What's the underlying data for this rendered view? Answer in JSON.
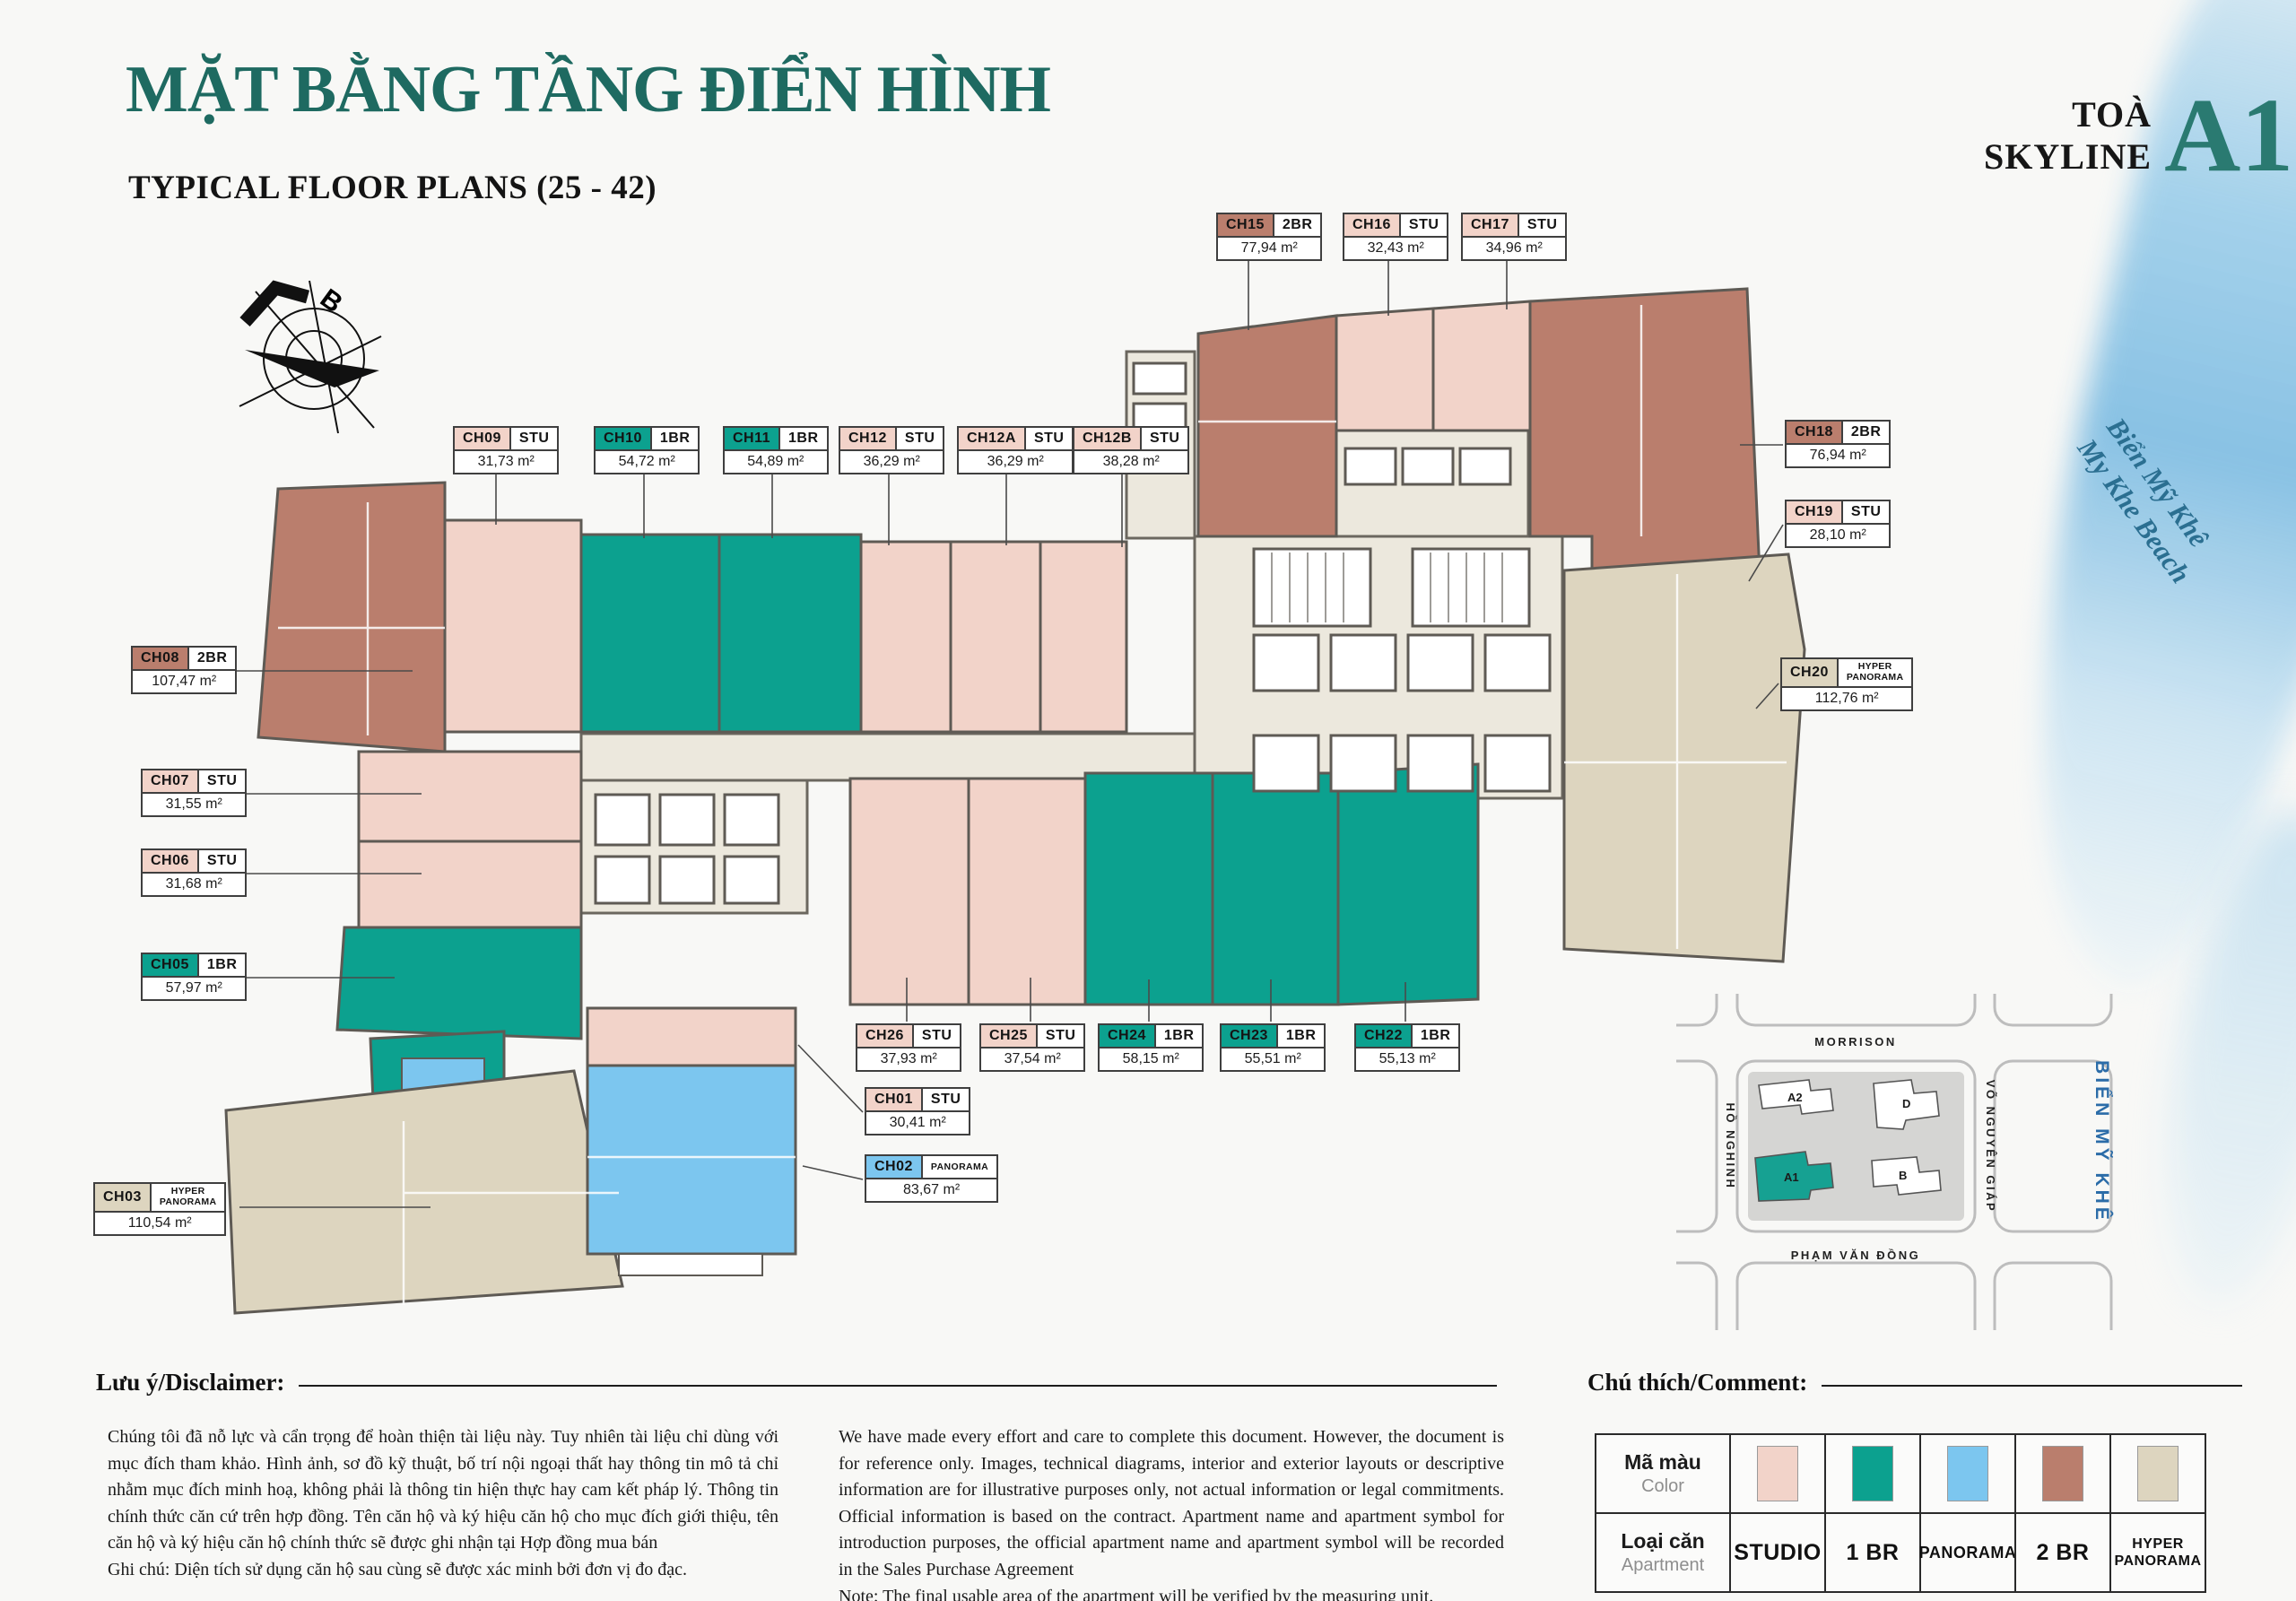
{
  "header": {
    "title_vi": "MẶT BẰNG TẦNG ĐIỂN HÌNH",
    "title_en": "TYPICAL FLOOR PLANS (25 - 42)",
    "tower_prefix": "TOÀ",
    "tower_brand": "SKYLINE",
    "tower_code": "A1"
  },
  "compass": {
    "north_label": "B"
  },
  "beach": {
    "line1": "Biển Mỹ Khê",
    "line2": "My Khe Beach"
  },
  "colors": {
    "accent_teal": "#1e6a61",
    "map_highlight": "#16a192",
    "sea_text": "#2b6ca8",
    "beach_text": "#2b6f91"
  },
  "apartments": [
    {
      "id": "CH01",
      "type": "STU",
      "area": "30,41 m²",
      "category": "STUDIO"
    },
    {
      "id": "CH02",
      "type": "PANORAMA",
      "area": "83,67 m²",
      "category": "PANORAMA"
    },
    {
      "id": "CH03",
      "type": "HYPER PANORAMA",
      "area": "110,54 m²",
      "category": "HYPER"
    },
    {
      "id": "CH05",
      "type": "1BR",
      "area": "57,97 m²",
      "category": "1BR"
    },
    {
      "id": "CH06",
      "type": "STU",
      "area": "31,68 m²",
      "category": "STUDIO"
    },
    {
      "id": "CH07",
      "type": "STU",
      "area": "31,55 m²",
      "category": "STUDIO"
    },
    {
      "id": "CH08",
      "type": "2BR",
      "area": "107,47 m²",
      "category": "2BR"
    },
    {
      "id": "CH09",
      "type": "STU",
      "area": "31,73 m²",
      "category": "STUDIO"
    },
    {
      "id": "CH10",
      "type": "1BR",
      "area": "54,72 m²",
      "category": "1BR"
    },
    {
      "id": "CH11",
      "type": "1BR",
      "area": "54,89 m²",
      "category": "1BR"
    },
    {
      "id": "CH12",
      "type": "STU",
      "area": "36,29 m²",
      "category": "STUDIO"
    },
    {
      "id": "CH12A",
      "type": "STU",
      "area": "36,29 m²",
      "category": "STUDIO"
    },
    {
      "id": "CH12B",
      "type": "STU",
      "area": "38,28 m²",
      "category": "STUDIO"
    },
    {
      "id": "CH15",
      "type": "2BR",
      "area": "77,94 m²",
      "category": "2BR"
    },
    {
      "id": "CH16",
      "type": "STU",
      "area": "32,43 m²",
      "category": "STUDIO"
    },
    {
      "id": "CH17",
      "type": "STU",
      "area": "34,96 m²",
      "category": "STUDIO"
    },
    {
      "id": "CH18",
      "type": "2BR",
      "area": "76,94 m²",
      "category": "2BR"
    },
    {
      "id": "CH19",
      "type": "STU",
      "area": "28,10 m²",
      "category": "STUDIO"
    },
    {
      "id": "CH20",
      "type": "HYPER PANORAMA",
      "area": "112,76 m²",
      "category": "HYPER"
    },
    {
      "id": "CH22",
      "type": "1BR",
      "area": "55,13 m²",
      "category": "1BR"
    },
    {
      "id": "CH23",
      "type": "1BR",
      "area": "55,51 m²",
      "category": "1BR"
    },
    {
      "id": "CH24",
      "type": "1BR",
      "area": "58,15 m²",
      "category": "1BR"
    },
    {
      "id": "CH25",
      "type": "STU",
      "area": "37,54 m²",
      "category": "STUDIO"
    },
    {
      "id": "CH26",
      "type": "STU",
      "area": "37,93 m²",
      "category": "STUDIO"
    }
  ],
  "legend": {
    "header": "Chú thích/Comment:",
    "color_label_vi": "Mã màu",
    "color_label_en": "Color",
    "type_label_vi": "Loại căn",
    "type_label_en": "Apartment",
    "entries": [
      {
        "key": "STUDIO",
        "label": "STUDIO",
        "color": "#f2d3c9"
      },
      {
        "key": "1BR",
        "label": "1 BR",
        "color": "#0ca18f"
      },
      {
        "key": "PANORAMA",
        "label": "PANORAMA",
        "color": "#7cc6ef"
      },
      {
        "key": "2BR",
        "label": "2 BR",
        "color": "#ba7e6d"
      },
      {
        "key": "HYPER",
        "label": "HYPER PANORAMA",
        "color": "#ddd5bf"
      }
    ]
  },
  "minimap": {
    "streets": {
      "top": "MORRISON",
      "left": "HỒ NGHINH",
      "right": "VÕ NGUYÊN GIÁP",
      "bottom": "PHẠM VĂN ĐỒNG"
    },
    "sea_label": "BIỂN MỸ KHÊ",
    "buildings": [
      {
        "id": "A2",
        "highlight": false
      },
      {
        "id": "D",
        "highlight": false
      },
      {
        "id": "A1",
        "highlight": true
      },
      {
        "id": "B",
        "highlight": false
      }
    ]
  },
  "disclaimer": {
    "header_vi": "Lưu ý/Disclaimer:",
    "text_vi": "Chúng tôi đã nỗ lực và cẩn trọng để hoàn thiện tài liệu này. Tuy nhiên tài liệu chỉ dùng với mục đích tham khảo. Hình ảnh, sơ đồ kỹ thuật, bố trí nội ngoại thất hay thông tin mô tả chỉ nhằm mục đích minh hoạ, không phải là thông tin hiện thực hay cam kết pháp lý. Thông tin chính thức căn cứ trên hợp đồng. Tên căn hộ và ký hiệu căn hộ cho mục đích giới thiệu, tên căn hộ và ký hiệu căn hộ chính thức sẽ được ghi nhận tại Hợp đồng mua bán",
    "note_vi": "Ghi chú: Diện tích sử dụng căn hộ sau cùng sẽ được xác minh bởi đơn vị đo đạc.",
    "text_en": "We have made every effort and care to complete this document. However, the document is for reference only. Images, technical diagrams, interior and exterior layouts or descriptive information are for illustrative purposes only, not actual information or legal commitments. Official information is based on the contract. Apartment name and apartment symbol for introduction purposes, the official apartment name and apartment symbol will be recorded in the Sales Purchase Agreement",
    "note_en": "Note: The final usable area of the apartment will be verified by the measuring unit."
  }
}
